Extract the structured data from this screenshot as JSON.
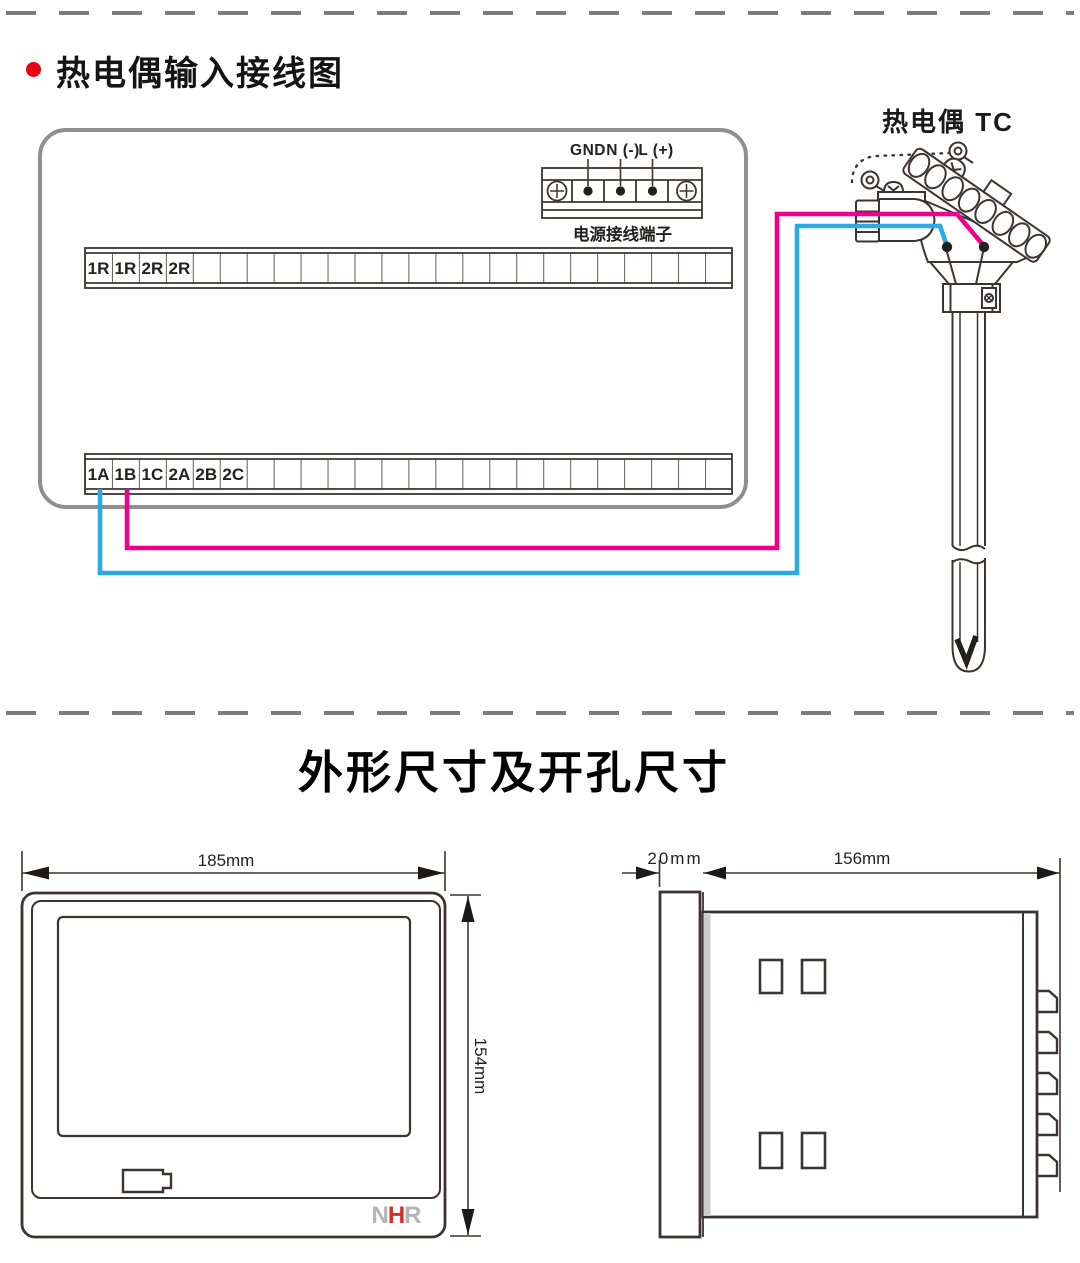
{
  "wiring_section": {
    "title": "热电偶输入接线图",
    "power_terminal": {
      "pin_labels": [
        "GND",
        "N (-)",
        "L (+)"
      ],
      "caption": "电源接线端子"
    },
    "upper_terminal_labels": [
      "1R",
      "1R",
      "2R",
      "2R"
    ],
    "lower_terminal_labels": [
      "1A",
      "1B",
      "1C",
      "2A",
      "2B",
      "2C"
    ],
    "sensor_label": "热电偶 TC"
  },
  "dimensions_section": {
    "title": "外形尺寸及开孔尺寸",
    "front_view": {
      "width": "185mm",
      "height": "154mm",
      "logo": [
        "N",
        "H",
        "R"
      ]
    },
    "side_view": {
      "bezel_depth": "20mm",
      "body_depth": "156mm"
    }
  },
  "colors": {
    "wire_positive": "#ec008c",
    "wire_negative": "#29abe2",
    "bullet_red": "#e60012",
    "logo_red": "#d52f27",
    "logo_gray": "#b2b4b6"
  }
}
